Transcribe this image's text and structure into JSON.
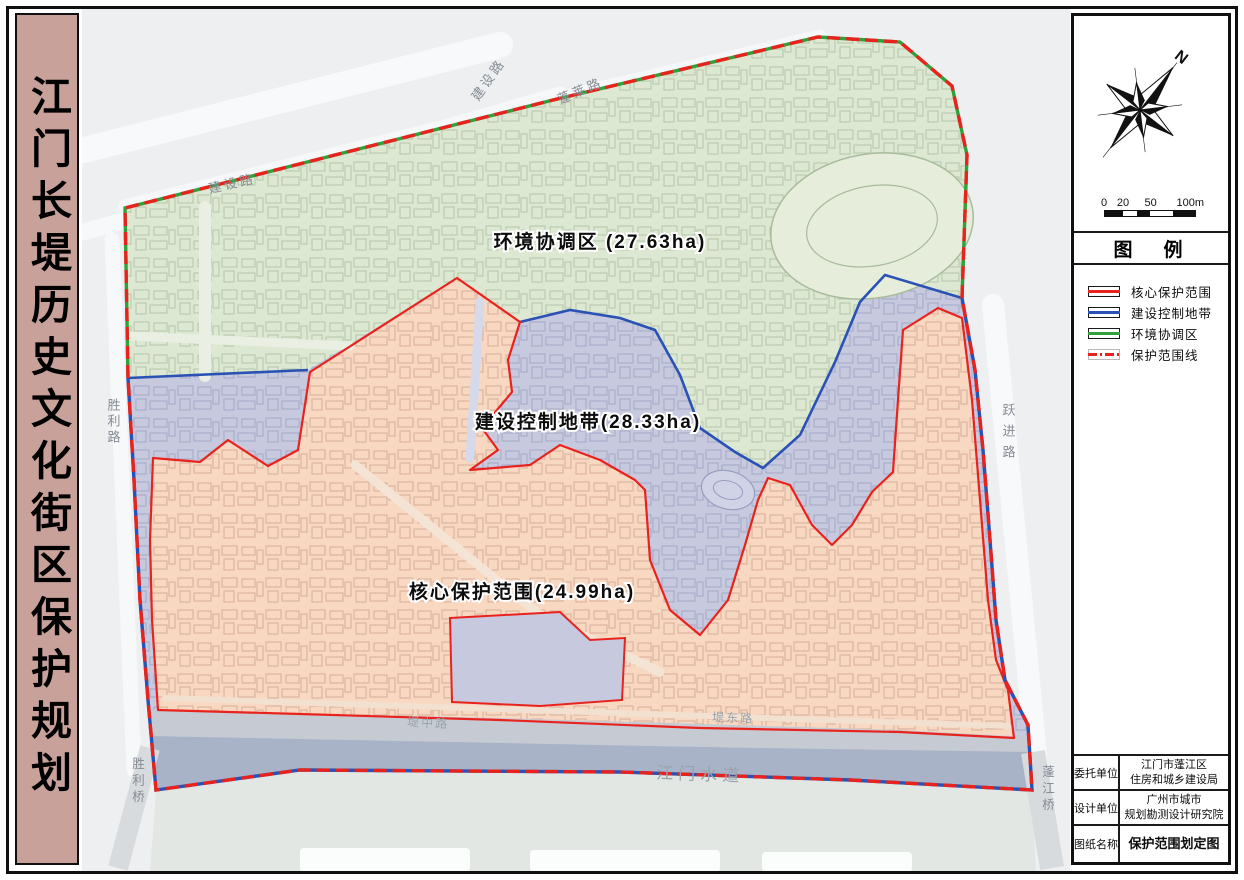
{
  "page": {
    "title": "江门长堤历史文化街区保护规划"
  },
  "map": {
    "zones": {
      "environment": {
        "label": "环境协调区 (27.63ha)",
        "fill": "#dde8d2",
        "area_ha": 27.63
      },
      "construction": {
        "label": "建设控制地带(28.33ha)",
        "fill": "#c7cade",
        "area_ha": 28.33
      },
      "core": {
        "label": "核心保护范围(24.99ha)",
        "fill": "#f9d8c2",
        "area_ha": 24.99
      }
    },
    "roads": {
      "jianshe_top": "建设路",
      "penglai": "蓬莱路",
      "jianshe_left": "建设路",
      "shengli_road": "胜利路",
      "yuejin_road": "跃进路",
      "dizhong_road": "堤中路",
      "didong_road": "堤东路",
      "river": "江门水道",
      "shengli_bridge": "胜利桥",
      "pengjiang_bridge": "蓬江桥"
    }
  },
  "sidebar": {
    "north_label": "N",
    "scale_ticks": [
      "0",
      "20",
      "50",
      "100m"
    ],
    "legend": {
      "title": "图　例",
      "items": [
        {
          "label": "核心保护范围",
          "color": "#e8231e",
          "style": "solid"
        },
        {
          "label": "建设控制地带",
          "color": "#2a52b5",
          "style": "solid"
        },
        {
          "label": "环境协调区",
          "color": "#2fa03c",
          "style": "solid"
        },
        {
          "label": "保护范围线",
          "color": "#e8231e",
          "style": "dash-dot"
        }
      ]
    },
    "title_block": {
      "rows": [
        {
          "label": "委托单位",
          "line1": "江门市蓬江区",
          "line2": "住房和城乡建设局"
        },
        {
          "label": "设计单位",
          "line1": "广州市城市",
          "line2": "规划勘测设计研究院"
        },
        {
          "label": "图纸名称",
          "line1": "保护范围划定图",
          "line2": ""
        }
      ]
    }
  },
  "colors": {
    "boundary_red": "#e8231e",
    "boundary_blue": "#2a52b5",
    "boundary_green": "#2fa03c",
    "river_fill": "#a9b3c7",
    "title_bar_bg": "#c8a29a"
  }
}
